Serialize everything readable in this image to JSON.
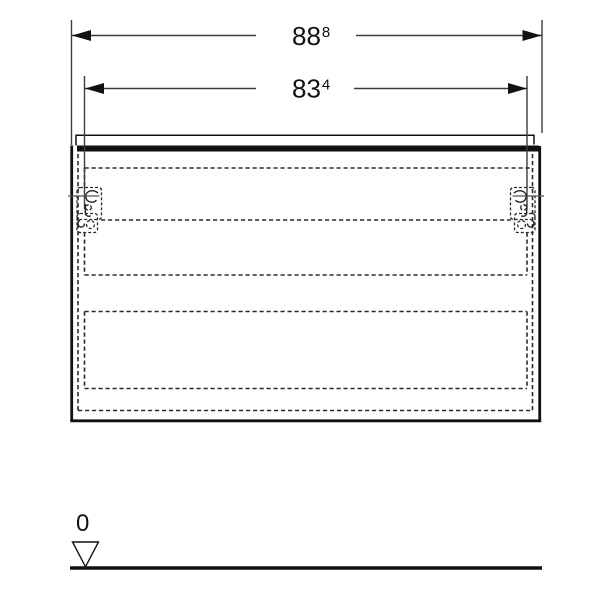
{
  "page": {
    "background": "#ffffff"
  },
  "colors": {
    "solid_line": "#111111",
    "dashed_line": "#2b2b2b",
    "dimension_line": "#3c3c3c",
    "text": "#111111",
    "background": "#ffffff"
  },
  "icons": {
    "dimension_arrowhead": "filled-triangle",
    "datum_marker": "open-triangle-down",
    "mount_point": "crosshair"
  },
  "dimensions": {
    "overall_width": {
      "main": "88",
      "sup": "8"
    },
    "inner_width": {
      "main": "83",
      "sup": "4"
    }
  },
  "datum": {
    "label": "0"
  }
}
